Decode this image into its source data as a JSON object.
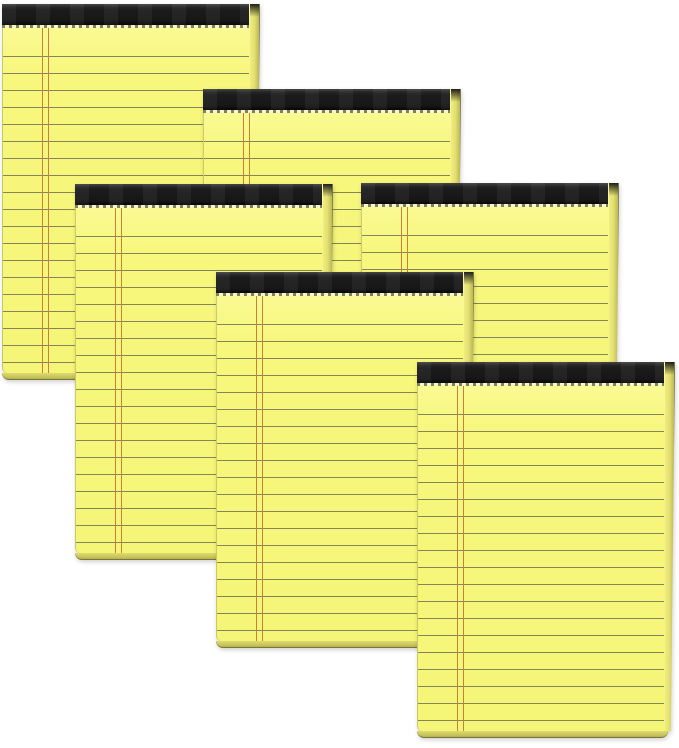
{
  "canvas": {
    "width": 679,
    "height": 748,
    "background": "#ffffff"
  },
  "colors": {
    "paper": "#f7f77d",
    "paper_highlight": "#fbfb9e",
    "ruled_line": "#85855a",
    "margin_line": "#c5823c",
    "binding": "#1b1b1b",
    "side_edge": "#e3e06f",
    "bottom_edge": "#c6c35c",
    "edge_border": "#72713f",
    "perforation_band": "#f6f6c8",
    "perforation_dash": "#80805c"
  },
  "pad_geometry": {
    "paper_width": 247,
    "paper_height": 369,
    "side_edge_width": 9,
    "bottom_edge_height": 7,
    "binding_height": 21,
    "perforation_height": 3,
    "margin_line_left": 39,
    "ruled_line_spacing": 17,
    "first_ruled_line_top": 52
  },
  "pads": [
    {
      "id": "pad-1",
      "x": 2,
      "y": 4,
      "z": 1
    },
    {
      "id": "pad-2",
      "x": 203,
      "y": 89,
      "z": 2
    },
    {
      "id": "pad-3",
      "x": 75,
      "y": 184,
      "z": 3
    },
    {
      "id": "pad-4",
      "x": 361,
      "y": 183,
      "z": 3
    },
    {
      "id": "pad-5",
      "x": 216,
      "y": 272,
      "z": 4
    },
    {
      "id": "pad-6",
      "x": 417,
      "y": 362,
      "z": 5
    }
  ]
}
